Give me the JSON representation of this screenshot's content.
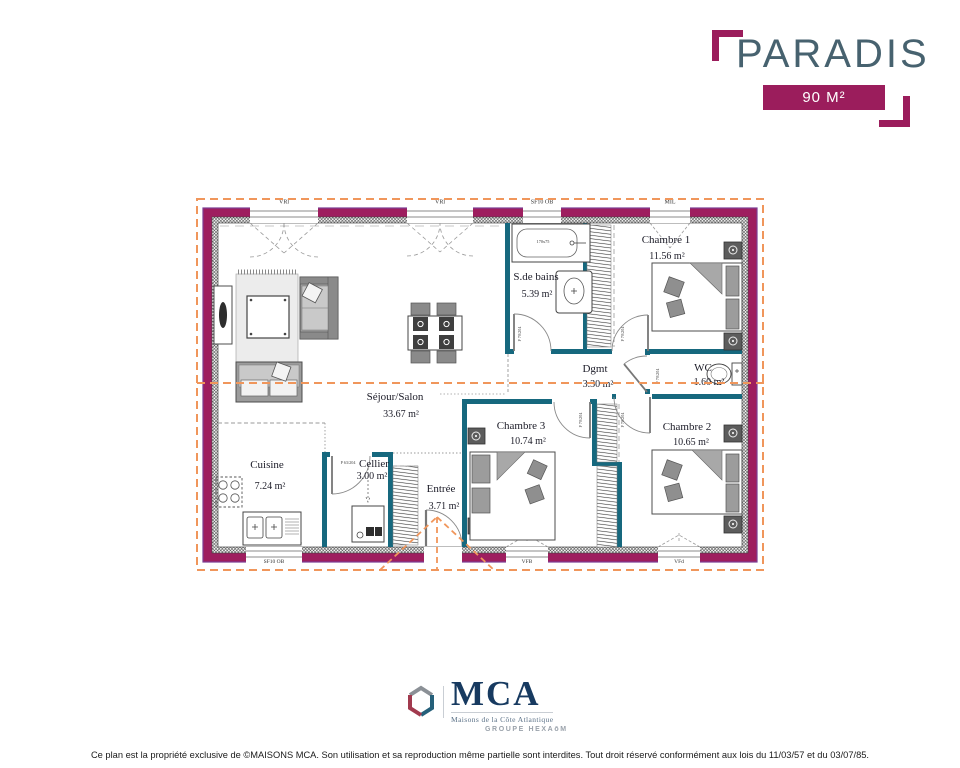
{
  "header": {
    "title": "PARADIS",
    "area_badge": "90 M²"
  },
  "plan": {
    "rooms": {
      "sejour": {
        "name": "Séjour/Salon",
        "area": "33.67 m²"
      },
      "cuisine": {
        "name": "Cuisine",
        "area": "7.24 m²"
      },
      "cellier": {
        "name": "Cellier",
        "area": "3.00 m²"
      },
      "entree": {
        "name": "Entrée",
        "area": "3.71 m²"
      },
      "sdb": {
        "name": "S.de bains",
        "area": "5.39 m²"
      },
      "dgmt": {
        "name": "Dgmt",
        "area": "3.30 m²"
      },
      "wc": {
        "name": "WC",
        "area": "1.60 m²"
      },
      "ch1": {
        "name": "Chambre 1",
        "area": "11.56 m²"
      },
      "ch2": {
        "name": "Chambre 2",
        "area": "10.65 m²"
      },
      "ch3": {
        "name": "Chambre 3",
        "area": "10.74 m²"
      }
    },
    "windows": {
      "top1": "VRl",
      "top2": "VRl",
      "bath": "SF10 OB",
      "ch1": "MIL",
      "cuisine": "SF10 OB",
      "ch3": "VFB",
      "ch2": "VFd"
    },
    "doors": {
      "standard": "P 70/204",
      "cellier": "P 63/204"
    },
    "fixtures": {
      "bathtub": "170x75"
    },
    "colors": {
      "wall": "#9E1E5F",
      "partition": "#16687E",
      "overhang": "#F0965B",
      "brand": "#9B1D5C"
    }
  },
  "footer": {
    "mca": "MCA",
    "subtitle": "Maisons de la Côte Atlantique",
    "group": "GROUPE HEXAōM",
    "disclaimer": "Ce plan est la propriété exclusive de ©MAISONS MCA. Son utilisation et sa reproduction même partielle sont interdites. Tout droit réservé conformément aux lois du 11/03/57 et du 03/07/85."
  }
}
